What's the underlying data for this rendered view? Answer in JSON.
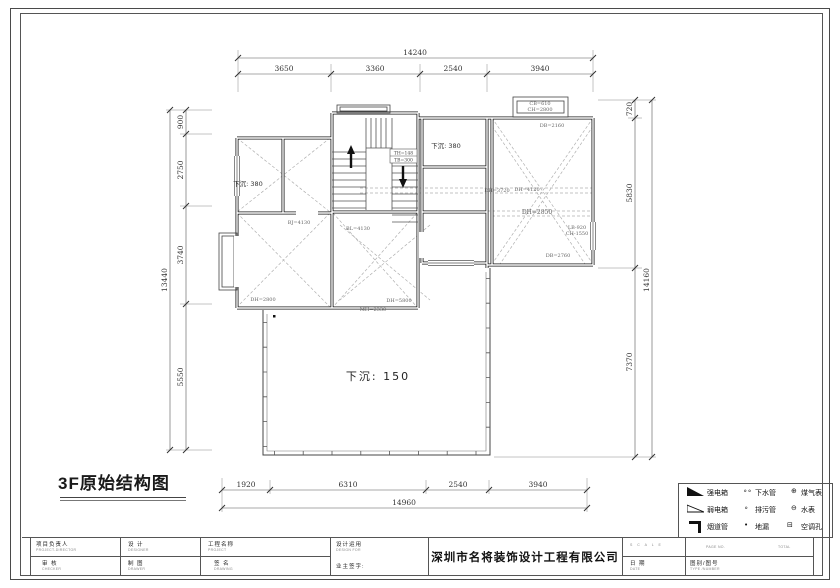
{
  "title": "3F原始结构图",
  "plan": {
    "rooms": {
      "left": "下沉: 380",
      "mid": "下沉: 380",
      "court": "下沉: 150"
    },
    "stairs": {
      "l1": "TH=148",
      "l2": "TB=300"
    },
    "ann": {
      "a1": "BJ=4130",
      "a2": "BL=4130",
      "a3": "DH=2800",
      "a4": "DH=5800",
      "a5": "MH=2330",
      "a6": "CB=610",
      "a7": "CH=2800",
      "a8": "DB=2160",
      "a9": "DH=3720",
      "a10": "DH=4120",
      "a11": "DH=2850",
      "a12": "LB-920",
      "a13": "CH-1550",
      "a14": "DB=2760"
    }
  },
  "dims": {
    "top": {
      "overall": "14240",
      "segs": [
        "3650",
        "3360",
        "2540",
        "3940"
      ]
    },
    "bottom": {
      "overall": "14960",
      "segs": [
        "1920",
        "6310",
        "2540",
        "3940"
      ]
    },
    "left": {
      "overall": "13440",
      "segs": [
        "900",
        "2750",
        "3740",
        "5550"
      ]
    },
    "right": {
      "overall": "14160",
      "segs": [
        "720",
        "5830",
        "7370"
      ]
    }
  },
  "legend": {
    "r1": {
      "l1": "强电箱",
      "s2": "∘∘",
      "l2": "下水管",
      "s3": "⊕",
      "l3": "煤气表"
    },
    "r2": {
      "l1": "弱电箱",
      "s2": "∘",
      "l2": "排污管",
      "s3": "⊖",
      "l3": "水表"
    },
    "r3": {
      "l1": "烟道管",
      "s2": "•",
      "l2": "地漏",
      "s3": "⊟",
      "l3": "空调孔"
    }
  },
  "titleblock": {
    "c1r1": "项目负责人",
    "c1r1e": "PROJECT-DIRECTOR",
    "c1r2": "审  核",
    "c1r2e": "CHECKER",
    "c2r1": "设  计",
    "c2r1e": "DESIGNER",
    "c2r2": "制  图",
    "c2r2e": "DRAWER",
    "c3r1": "工程名称",
    "c3r1e": "PROJECT",
    "c3r2": "签  名",
    "c3r2e": "DRAWING",
    "c4r1": "设计运用",
    "c4r1e": "DESIGN FOR",
    "c4r2": "业主签字:",
    "company": "深圳市名将装饰设计工程有限公司",
    "scale": "S C A L E",
    "date": "日  期",
    "datee": "DATE",
    "pageno": "PAGE NO.",
    "total": "TOTAL",
    "fig": "图别/图号",
    "fige": "TYPE /NUMBER"
  }
}
